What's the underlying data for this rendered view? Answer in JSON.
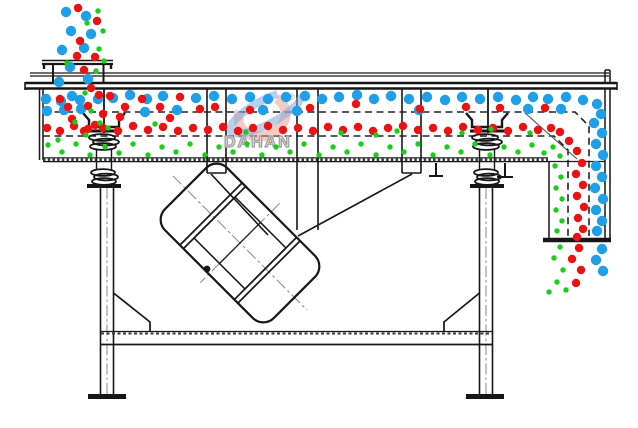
{
  "diagram_title": "linear-vibrating-screen-particle-flow",
  "watermark": {
    "brand": "DAHAN",
    "reg_mark": "®"
  },
  "colors": {
    "line": "#161616",
    "centerline": "#8a8a8a",
    "large_particle": "#1E9FE8",
    "medium_particle": "#ED1111",
    "small_particle": "#19CE19",
    "watermark_blue": "rgba(125,168,220,0.55)",
    "watermark_red": "rgba(236,150,140,0.5)",
    "watermark_text": "#a0a0a0"
  },
  "particles": {
    "radius": {
      "large": 5.2,
      "medium": 4.2,
      "small": 2.7
    },
    "large": [
      [
        66,
        12
      ],
      [
        86,
        16
      ],
      [
        71,
        31
      ],
      [
        91,
        34
      ],
      [
        62,
        50
      ],
      [
        84,
        48
      ],
      [
        70,
        67
      ],
      [
        88,
        79
      ],
      [
        59,
        82
      ],
      [
        72,
        96
      ],
      [
        46,
        99
      ],
      [
        61,
        101
      ],
      [
        80,
        100
      ],
      [
        98,
        99
      ],
      [
        47,
        111
      ],
      [
        64,
        110
      ],
      [
        81,
        109
      ],
      [
        113,
        98
      ],
      [
        130,
        95
      ],
      [
        147,
        99
      ],
      [
        163,
        96
      ],
      [
        145,
        112
      ],
      [
        177,
        110
      ],
      [
        196,
        98
      ],
      [
        214,
        96
      ],
      [
        232,
        99
      ],
      [
        250,
        97
      ],
      [
        268,
        99
      ],
      [
        286,
        97
      ],
      [
        263,
        110
      ],
      [
        297,
        111
      ],
      [
        305,
        96
      ],
      [
        322,
        99
      ],
      [
        339,
        97
      ],
      [
        357,
        95
      ],
      [
        374,
        99
      ],
      [
        391,
        96
      ],
      [
        409,
        99
      ],
      [
        427,
        97
      ],
      [
        445,
        100
      ],
      [
        419,
        110
      ],
      [
        462,
        97
      ],
      [
        480,
        99
      ],
      [
        498,
        97
      ],
      [
        516,
        100
      ],
      [
        533,
        97
      ],
      [
        528,
        109
      ],
      [
        548,
        99
      ],
      [
        566,
        97
      ],
      [
        583,
        100
      ],
      [
        561,
        109
      ],
      [
        597,
        104
      ],
      [
        601,
        114
      ],
      [
        594,
        123
      ],
      [
        602,
        133
      ],
      [
        596,
        144
      ],
      [
        603,
        155
      ],
      [
        596,
        166
      ],
      [
        602,
        177
      ],
      [
        595,
        188
      ],
      [
        603,
        199
      ],
      [
        596,
        210
      ],
      [
        602,
        221
      ],
      [
        597,
        231
      ],
      [
        602,
        249
      ],
      [
        596,
        260
      ],
      [
        603,
        271
      ]
    ],
    "medium": [
      [
        78,
        8
      ],
      [
        97,
        21
      ],
      [
        80,
        41
      ],
      [
        95,
        57
      ],
      [
        77,
        56
      ],
      [
        91,
        88
      ],
      [
        84,
        70
      ],
      [
        99,
        95
      ],
      [
        68,
        107
      ],
      [
        88,
        106
      ],
      [
        103,
        114
      ],
      [
        72,
        119
      ],
      [
        95,
        125
      ],
      [
        84,
        131
      ],
      [
        60,
        99
      ],
      [
        110,
        96
      ],
      [
        125,
        107
      ],
      [
        142,
        99
      ],
      [
        160,
        107
      ],
      [
        180,
        97
      ],
      [
        200,
        109
      ],
      [
        215,
        107
      ],
      [
        250,
        110
      ],
      [
        310,
        108
      ],
      [
        356,
        104
      ],
      [
        420,
        109
      ],
      [
        466,
        107
      ],
      [
        500,
        108
      ],
      [
        545,
        108
      ],
      [
        47,
        128
      ],
      [
        60,
        131
      ],
      [
        74,
        126
      ],
      [
        88,
        129
      ],
      [
        103,
        128
      ],
      [
        118,
        131
      ],
      [
        133,
        126
      ],
      [
        148,
        130
      ],
      [
        120,
        117
      ],
      [
        163,
        127
      ],
      [
        178,
        131
      ],
      [
        193,
        128
      ],
      [
        170,
        118
      ],
      [
        208,
        130
      ],
      [
        223,
        127
      ],
      [
        238,
        131
      ],
      [
        253,
        128
      ],
      [
        268,
        126
      ],
      [
        283,
        130
      ],
      [
        298,
        128
      ],
      [
        313,
        131
      ],
      [
        328,
        127
      ],
      [
        343,
        130
      ],
      [
        358,
        127
      ],
      [
        373,
        131
      ],
      [
        388,
        128
      ],
      [
        403,
        126
      ],
      [
        418,
        130
      ],
      [
        433,
        128
      ],
      [
        448,
        131
      ],
      [
        463,
        127
      ],
      [
        478,
        130
      ],
      [
        493,
        128
      ],
      [
        508,
        131
      ],
      [
        523,
        127
      ],
      [
        538,
        130
      ],
      [
        551,
        128
      ],
      [
        560,
        132
      ],
      [
        569,
        141
      ],
      [
        577,
        151
      ],
      [
        582,
        163
      ],
      [
        576,
        174
      ],
      [
        583,
        185
      ],
      [
        577,
        196
      ],
      [
        584,
        207
      ],
      [
        578,
        218
      ],
      [
        583,
        229
      ],
      [
        577,
        237
      ],
      [
        579,
        248
      ],
      [
        572,
        259
      ],
      [
        581,
        270
      ],
      [
        576,
        283
      ]
    ],
    "small": [
      [
        98,
        11
      ],
      [
        103,
        31
      ],
      [
        87,
        23
      ],
      [
        99,
        49
      ],
      [
        67,
        63
      ],
      [
        96,
        71
      ],
      [
        85,
        93
      ],
      [
        104,
        61
      ],
      [
        91,
        111
      ],
      [
        100,
        123
      ],
      [
        86,
        135
      ],
      [
        108,
        128
      ],
      [
        75,
        122
      ],
      [
        155,
        124
      ],
      [
        246,
        132
      ],
      [
        341,
        133
      ],
      [
        376,
        135
      ],
      [
        397,
        131
      ],
      [
        462,
        133
      ],
      [
        491,
        129
      ],
      [
        530,
        133
      ],
      [
        58,
        140
      ],
      [
        48,
        145
      ],
      [
        62,
        152
      ],
      [
        76,
        144
      ],
      [
        90,
        155
      ],
      [
        105,
        147
      ],
      [
        119,
        153
      ],
      [
        133,
        144
      ],
      [
        148,
        155
      ],
      [
        162,
        147
      ],
      [
        176,
        152
      ],
      [
        190,
        144
      ],
      [
        205,
        155
      ],
      [
        219,
        147
      ],
      [
        233,
        152
      ],
      [
        247,
        144
      ],
      [
        262,
        155
      ],
      [
        276,
        147
      ],
      [
        290,
        152
      ],
      [
        304,
        144
      ],
      [
        319,
        155
      ],
      [
        333,
        147
      ],
      [
        347,
        152
      ],
      [
        361,
        144
      ],
      [
        376,
        155
      ],
      [
        390,
        147
      ],
      [
        404,
        152
      ],
      [
        418,
        144
      ],
      [
        433,
        155
      ],
      [
        447,
        147
      ],
      [
        461,
        152
      ],
      [
        475,
        144
      ],
      [
        490,
        155
      ],
      [
        504,
        147
      ],
      [
        518,
        152
      ],
      [
        532,
        145
      ],
      [
        544,
        153
      ],
      [
        553,
        147
      ],
      [
        560,
        156
      ],
      [
        555,
        166
      ],
      [
        561,
        177
      ],
      [
        556,
        188
      ],
      [
        562,
        199
      ],
      [
        556,
        210
      ],
      [
        562,
        221
      ],
      [
        557,
        231
      ],
      [
        560,
        247
      ],
      [
        554,
        258
      ],
      [
        563,
        270
      ],
      [
        557,
        282
      ],
      [
        549,
        292
      ],
      [
        566,
        290
      ]
    ]
  }
}
